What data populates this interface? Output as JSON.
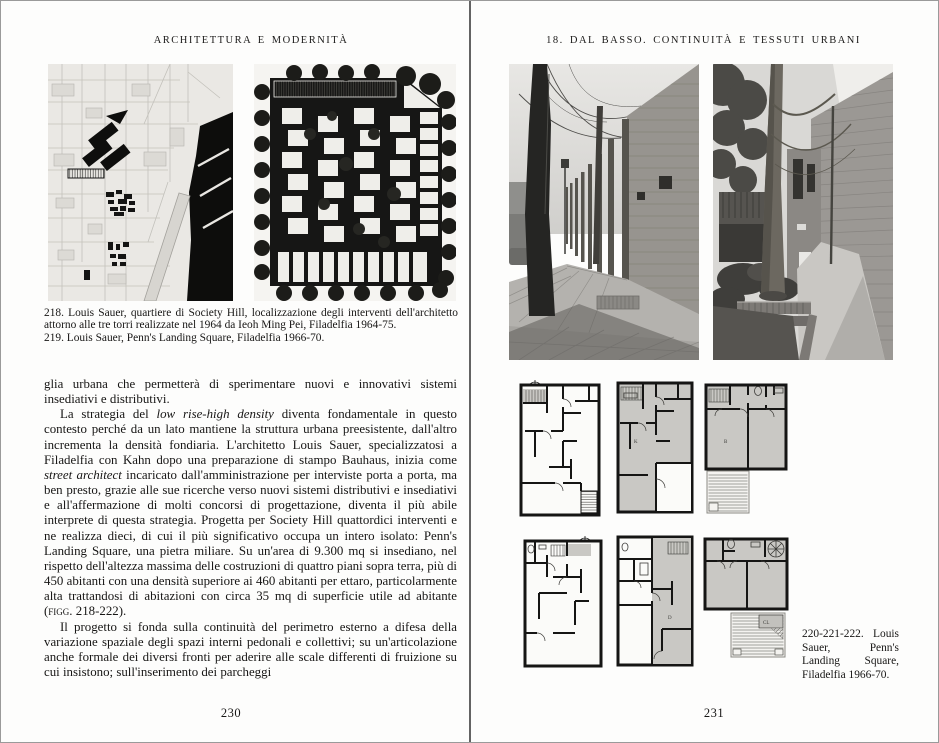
{
  "left_page": {
    "running_head": "ARCHITETTURA E MODERNITÀ",
    "captions": [
      "218. Louis Sauer, quartiere di Society Hill, localizzazione degli interventi dell'architetto attorno alle tre torri realizzate nel 1964 da Ieoh Ming Pei, Filadelfia 1964-75.",
      "219. Louis Sauer, Penn's Landing Square, Filadelfia 1966-70."
    ],
    "paragraphs": [
      [
        {
          "t": "glia urbana che permetterà di sperimentare nuovi e innovativi sistemi insediativi e distributivi."
        }
      ],
      [
        {
          "t": "La strategia del "
        },
        {
          "t": "low rise-high density",
          "i": true
        },
        {
          "t": " diventa fondamentale in questo contesto perché da un lato mantiene la struttura urbana preesistente, dall'altro incrementa la densità fondiaria. L'architetto Louis Sauer, specializzatosi a Filadelfia con Kahn dopo una preparazione di stampo Bauhaus, inizia come "
        },
        {
          "t": "street architect",
          "i": true
        },
        {
          "t": " incaricato dall'amministrazione per interviste porta a porta, ma ben presto, grazie alle sue ricerche verso nuovi sistemi distributivi e insediativi e all'affermazione di molti concorsi di progettazione, diventa il più abile interprete di questa strategia. Progetta per Society Hill quattordici interventi e ne realizza dieci, di cui il più significativo occupa un intero isolato: Penn's Landing Square, una pietra miliare. Su un'area di 9.300 mq si insediano, nel rispetto dell'altezza massima delle costruzioni di quattro piani sopra terra, più di 450 abitanti con una densità superiore ai 460 abitanti per ettaro, particolarmente alta trattandosi di abitazioni con circa 35 mq di superficie utile ad abitante ("
        },
        {
          "t": "figg. 218-222",
          "sc": true
        },
        {
          "t": ")."
        }
      ],
      [
        {
          "t": "Il progetto si fonda sulla continuità del perimetro esterno a difesa della variazione spaziale degli spazi interni pedonali e collettivi; su un'articolazione anche formale dei diversi fronti per aderire alle scale differenti di fruizione su cui insistono; sull'inserimento dei parcheggi"
        }
      ]
    ],
    "page_number": "230"
  },
  "right_page": {
    "running_head": "18. DAL BASSO. CONTINUITÀ E TESSUTI URBANI",
    "caption": "220-221-222. Louis Sauer, Penn's Landing Square, Filadelfia 1966-70.",
    "page_number": "231"
  },
  "floor_plans": {
    "room_labels": {
      "kitchen": "K",
      "bedroom": "B",
      "dining": "D",
      "closet": "CL"
    }
  },
  "colors": {
    "paper": "#fdfdfc",
    "ink": "#171615",
    "plan_gray": "#c9c8c4",
    "map_black": "#0d0d0c"
  }
}
